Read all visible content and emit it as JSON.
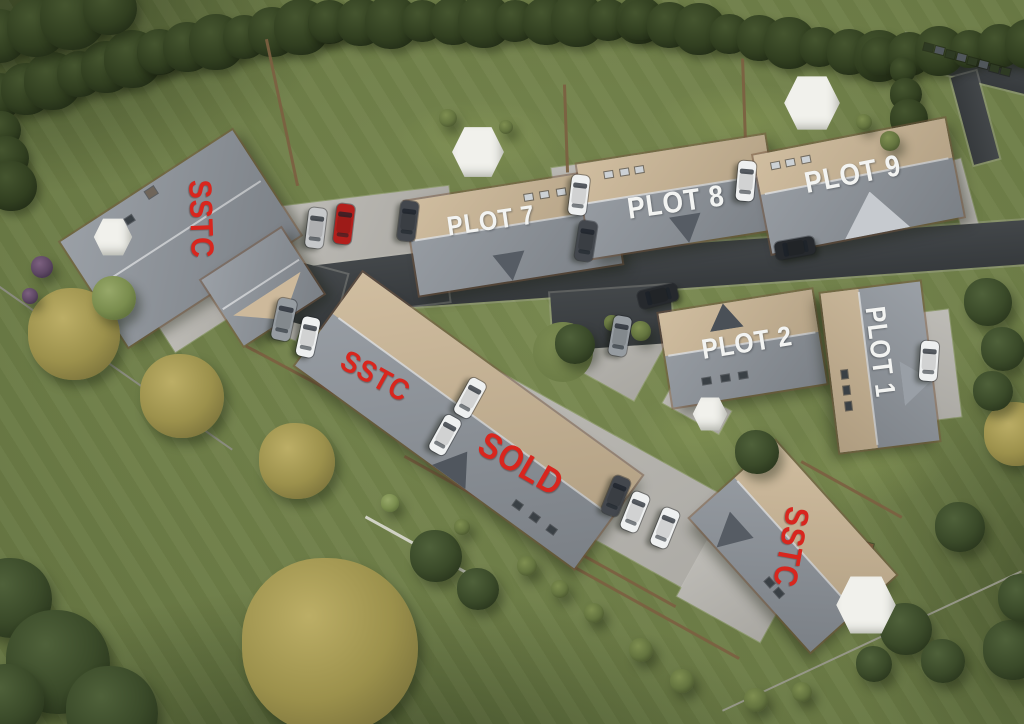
{
  "scene": {
    "width": 1024,
    "height": 724,
    "description": "Aerial 3D render site plan of housing development with plot and sale-status labels"
  },
  "palette": {
    "label_red": "#d8261e",
    "label_white": "#f3f4f2",
    "grass": "#6d7d47",
    "grass_light": "#7c8c52",
    "road": "#3b3f42",
    "paving": "#b6b4ae",
    "roof_gray": "#8f959c",
    "roof_tan": "#cbb695",
    "car_colors": {
      "silver": "#c6c8ca",
      "red": "#b31f1c",
      "dark": "#43474d",
      "white": "#eef0f0",
      "gray": "#969ca1",
      "black": "#26292d"
    },
    "tree": {
      "dark": [
        "#4f613a",
        "#3a4a29",
        "#27331b"
      ],
      "yellow": [
        "#bcae66",
        "#9c914c",
        "#78703a"
      ],
      "olive": [
        "#7f8f51",
        "#64743f",
        "#46522c"
      ],
      "light": [
        "#97a869",
        "#7a8d4e",
        "#5a6b38"
      ],
      "hedge": [
        "#45552f",
        "#313f20",
        "#1f2915"
      ],
      "purple": [
        "#7d6180",
        "#5d4763",
        "#3f3047"
      ]
    }
  },
  "labels": [
    {
      "id": "sstc-west-label",
      "text": "SSTC",
      "x": 201,
      "y": 219,
      "rot": 88,
      "size": 32,
      "color": "red"
    },
    {
      "id": "plot-7-label",
      "text": "PLOT 7",
      "x": 491,
      "y": 221,
      "rot": -8,
      "size": 27,
      "color": "white"
    },
    {
      "id": "plot-8-label",
      "text": "PLOT 8",
      "x": 676,
      "y": 203,
      "rot": -8,
      "size": 30,
      "color": "white"
    },
    {
      "id": "plot-9-label",
      "text": "PLOT 9",
      "x": 853,
      "y": 175,
      "rot": -11,
      "size": 30,
      "color": "white"
    },
    {
      "id": "plot-2-label",
      "text": "PLOT 2",
      "x": 747,
      "y": 343,
      "rot": -9,
      "size": 28,
      "color": "white"
    },
    {
      "id": "plot-1-label",
      "text": "PLOT 1",
      "x": 880,
      "y": 352,
      "rot": 83,
      "size": 28,
      "color": "white"
    },
    {
      "id": "sstc-mid-label",
      "text": "SSTC",
      "x": 375,
      "y": 377,
      "rot": 29,
      "size": 30,
      "color": "red"
    },
    {
      "id": "sold-label",
      "text": "SOLD",
      "x": 521,
      "y": 464,
      "rot": 30,
      "size": 36,
      "color": "red"
    },
    {
      "id": "sstc-south-label",
      "text": "SSTC",
      "x": 791,
      "y": 547,
      "rot": 100,
      "size": 33,
      "color": "red"
    }
  ],
  "houses": [
    {
      "id": "sstc-west",
      "x": 180,
      "y": 238,
      "w": 205,
      "h": 125,
      "rot": -33,
      "split": 0,
      "lights": [
        [
          0.18,
          0.15
        ],
        [
          0.26,
          0.15
        ],
        [
          0.34,
          0.15
        ]
      ],
      "lightColor": "dark",
      "chimney": [
        0.5,
        0.06
      ]
    },
    {
      "id": "sstc-west-wing",
      "x": 262,
      "y": 287,
      "w": 95,
      "h": 78,
      "rot": -33,
      "split": 0,
      "gable": {
        "side": "bottom",
        "at": 0.5,
        "wf": 0.85,
        "hf": 0.8,
        "apex": "out",
        "color": "#cdb99b"
      }
    },
    {
      "id": "plot-7",
      "x": 513,
      "y": 232,
      "w": 205,
      "h": 95,
      "rot": -9,
      "split": 0.42,
      "tan": "top",
      "lights": [
        [
          0.6,
          0.16
        ],
        [
          0.68,
          0.16
        ],
        [
          0.76,
          0.16
        ]
      ],
      "gable": {
        "side": "bottom",
        "at": 0.46,
        "wf": 0.16,
        "hf": 0.6,
        "apex": "out",
        "color": "#565c64"
      }
    },
    {
      "id": "plot-8",
      "x": 678,
      "y": 196,
      "w": 190,
      "h": 95,
      "rot": -9,
      "split": 0.42,
      "tan": "top",
      "lights": [
        [
          0.16,
          0.16
        ],
        [
          0.24,
          0.16
        ],
        [
          0.32,
          0.16
        ]
      ],
      "gable": {
        "side": "bottom",
        "at": 0.52,
        "wf": 0.17,
        "hf": 0.6,
        "apex": "out",
        "color": "#565c64"
      }
    },
    {
      "id": "plot-9",
      "x": 858,
      "y": 186,
      "w": 195,
      "h": 100,
      "rot": -11,
      "split": 0.4,
      "tan": "top",
      "lights": [
        [
          0.1,
          0.14
        ],
        [
          0.18,
          0.14
        ],
        [
          0.26,
          0.14
        ]
      ],
      "gable": {
        "side": "bottom",
        "at": 0.55,
        "wf": 0.34,
        "hf": 0.85,
        "apex": "in",
        "color": "#c6cacf"
      }
    },
    {
      "id": "plot-2",
      "x": 742,
      "y": 348,
      "w": 155,
      "h": 95,
      "rot": -9,
      "split": 0.45,
      "tan": "top",
      "lightColor": "dark",
      "lights": [
        [
          0.24,
          0.78
        ],
        [
          0.36,
          0.78
        ],
        [
          0.48,
          0.78
        ]
      ],
      "gable": {
        "side": "top",
        "at": 0.42,
        "wf": 0.22,
        "hf": 0.55,
        "apex": "out",
        "color": "#4a5057"
      }
    },
    {
      "id": "plot-1",
      "x": 880,
      "y": 367,
      "w": 160,
      "h": 100,
      "rot": 83,
      "split": 0.38,
      "tan": "bottom",
      "lightColor": "dark",
      "lights": [
        [
          0.52,
          0.86
        ],
        [
          0.62,
          0.86
        ],
        [
          0.72,
          0.86
        ]
      ],
      "gable": {
        "side": "top",
        "at": 0.62,
        "wf": 0.28,
        "hf": 0.6,
        "apex": "out",
        "color": "#999fa6"
      }
    },
    {
      "id": "sstc-sold-terrace",
      "x": 468,
      "y": 420,
      "w": 345,
      "h": 115,
      "rot": 36,
      "split": 0.44,
      "tan": "top",
      "lightColor": "dark",
      "lights": [
        [
          0.76,
          0.84
        ],
        [
          0.82,
          0.84
        ],
        [
          0.88,
          0.84
        ]
      ],
      "gable": {
        "side": "bottom",
        "at": 0.55,
        "wf": 0.12,
        "hf": 0.55,
        "apex": "in",
        "color": "#50565e"
      }
    },
    {
      "id": "sstc-south",
      "x": 793,
      "y": 546,
      "w": 180,
      "h": 115,
      "rot": 48,
      "split": 0.48,
      "tan": "top",
      "lightColor": "dark",
      "lights": [
        [
          0.56,
          0.86
        ],
        [
          0.64,
          0.86
        ]
      ],
      "gable": {
        "side": "bottom",
        "at": 0.22,
        "wf": 0.2,
        "hf": 0.6,
        "apex": "out",
        "color": "#565c64"
      }
    }
  ],
  "roads": [
    {
      "x": 655,
      "y": 268,
      "w": 760,
      "h": 44,
      "rot": -4
    },
    {
      "x": 352,
      "y": 287,
      "w": 190,
      "h": 52,
      "rot": -7
    },
    {
      "x": 296,
      "y": 292,
      "w": 90,
      "h": 60,
      "rot": 15
    },
    {
      "x": 612,
      "y": 318,
      "w": 120,
      "h": 58,
      "rot": -4
    },
    {
      "x": 966,
      "y": 64,
      "w": 130,
      "h": 30,
      "rot": 14
    },
    {
      "x": 975,
      "y": 118,
      "w": 90,
      "h": 26,
      "rot": 75
    }
  ],
  "paving": [
    {
      "x": 368,
      "y": 228,
      "w": 170,
      "h": 64,
      "rot": -7
    },
    {
      "x": 584,
      "y": 214,
      "w": 100,
      "h": 52,
      "rot": 82
    },
    {
      "x": 748,
      "y": 186,
      "w": 92,
      "h": 46,
      "rot": 81
    },
    {
      "x": 930,
      "y": 366,
      "w": 108,
      "h": 50,
      "rot": 83
    },
    {
      "x": 262,
      "y": 301,
      "w": 92,
      "h": 48,
      "rot": 22
    },
    {
      "x": 205,
      "y": 315,
      "w": 90,
      "h": 30,
      "rot": -33
    },
    {
      "x": 604,
      "y": 487,
      "w": 420,
      "h": 100,
      "rot": 29
    },
    {
      "x": 612,
      "y": 337,
      "w": 100,
      "h": 90,
      "rot": 29
    },
    {
      "x": 697,
      "y": 407,
      "w": 64,
      "h": 26,
      "rot": 29
    },
    {
      "x": 733,
      "y": 592,
      "w": 95,
      "h": 62,
      "rot": 29
    },
    {
      "x": 962,
      "y": 196,
      "w": 74,
      "h": 17,
      "rot": 75
    }
  ],
  "islands": [
    {
      "x": 563,
      "y": 352,
      "r": 30
    }
  ],
  "hedges": [
    {
      "from": [
        0,
        96
      ],
      "to": [
        160,
        52
      ],
      "r": 26,
      "step": 30
    },
    {
      "from": [
        160,
        52
      ],
      "to": [
        330,
        22
      ],
      "r": 25,
      "step": 30
    },
    {
      "from": [
        330,
        22
      ],
      "to": [
        640,
        20
      ],
      "r": 24,
      "step": 32
    },
    {
      "from": [
        640,
        20
      ],
      "to": [
        880,
        56
      ],
      "r": 23,
      "step": 30
    },
    {
      "from": [
        880,
        56
      ],
      "to": [
        1030,
        44
      ],
      "r": 22,
      "step": 30
    },
    {
      "from": [
        903,
        70
      ],
      "to": [
        918,
        190
      ],
      "r": 16,
      "step": 24
    },
    {
      "from": [
        0,
        36
      ],
      "to": [
        110,
        8
      ],
      "r": 30,
      "step": 34
    },
    {
      "from": [
        2,
        130
      ],
      "to": [
        12,
        186
      ],
      "r": 22,
      "step": 28
    }
  ],
  "fences": [
    {
      "x": 115,
      "y": 368,
      "len": 285,
      "rot": 35,
      "t": 2,
      "c": "#8d8d84"
    },
    {
      "x": 290,
      "y": 369,
      "len": 100,
      "rot": 28,
      "t": 3,
      "c": "#7c5f41"
    },
    {
      "x": 282,
      "y": 112,
      "len": 150,
      "rot": 78,
      "t": 3,
      "c": "#7c5f41"
    },
    {
      "x": 566,
      "y": 128,
      "len": 88,
      "rot": 88,
      "t": 3,
      "c": "#7c5f41"
    },
    {
      "x": 744,
      "y": 99,
      "len": 82,
      "rot": 88,
      "t": 3,
      "c": "#7c5f41"
    },
    {
      "x": 540,
      "y": 531,
      "len": 310,
      "rot": 29,
      "t": 3,
      "c": "#7c5f41"
    },
    {
      "x": 851,
      "y": 489,
      "len": 115,
      "rot": 29,
      "t": 3,
      "c": "#7c5f41"
    },
    {
      "x": 424,
      "y": 549,
      "len": 135,
      "rot": 29,
      "t": 3,
      "c": "#d9d9d0"
    },
    {
      "x": 872,
      "y": 641,
      "len": 330,
      "rot": -25,
      "t": 2,
      "c": "#9a9a8e"
    },
    {
      "x": 656,
      "y": 612,
      "len": 190,
      "rot": 29,
      "t": 3,
      "c": "#7c5f41"
    }
  ],
  "planters": [
    {
      "x": 928,
      "y": 47,
      "c": "#2e3a23"
    },
    {
      "x": 939,
      "y": 50,
      "c": "#51575c"
    },
    {
      "x": 950,
      "y": 54,
      "c": "#2e3a23"
    },
    {
      "x": 961,
      "y": 57,
      "c": "#51575c"
    },
    {
      "x": 972,
      "y": 61,
      "c": "#2e3a23"
    },
    {
      "x": 983,
      "y": 64,
      "c": "#51575c"
    },
    {
      "x": 994,
      "y": 68,
      "c": "#2e3a23"
    },
    {
      "x": 1005,
      "y": 71,
      "c": "#2e3a23"
    },
    {
      "x": 868,
      "y": 546,
      "c": "#7a5a3a"
    }
  ],
  "trees": [
    {
      "x": 12,
      "y": 598,
      "r": 40,
      "t": "dark"
    },
    {
      "x": 58,
      "y": 662,
      "r": 52,
      "t": "dark"
    },
    {
      "x": 112,
      "y": 712,
      "r": 46,
      "t": "dark"
    },
    {
      "x": 8,
      "y": 700,
      "r": 36,
      "t": "dark"
    },
    {
      "x": 330,
      "y": 646,
      "r": 88,
      "t": "yellow"
    },
    {
      "x": 74,
      "y": 334,
      "r": 46,
      "t": "yellow"
    },
    {
      "x": 182,
      "y": 396,
      "r": 42,
      "t": "yellow"
    },
    {
      "x": 297,
      "y": 461,
      "r": 38,
      "t": "yellow"
    },
    {
      "x": 1016,
      "y": 434,
      "r": 32,
      "t": "yellow"
    },
    {
      "x": 114,
      "y": 298,
      "r": 22,
      "t": "light"
    },
    {
      "x": 436,
      "y": 556,
      "r": 26,
      "t": "dark"
    },
    {
      "x": 478,
      "y": 589,
      "r": 21,
      "t": "dark"
    },
    {
      "x": 575,
      "y": 344,
      "r": 20,
      "t": "dark"
    },
    {
      "x": 757,
      "y": 452,
      "r": 22,
      "t": "dark"
    },
    {
      "x": 988,
      "y": 302,
      "r": 24,
      "t": "dark"
    },
    {
      "x": 1003,
      "y": 349,
      "r": 22,
      "t": "dark"
    },
    {
      "x": 993,
      "y": 391,
      "r": 20,
      "t": "dark"
    },
    {
      "x": 960,
      "y": 527,
      "r": 25,
      "t": "dark"
    },
    {
      "x": 906,
      "y": 629,
      "r": 26,
      "t": "dark"
    },
    {
      "x": 943,
      "y": 661,
      "r": 22,
      "t": "dark"
    },
    {
      "x": 874,
      "y": 664,
      "r": 18,
      "t": "dark"
    },
    {
      "x": 1013,
      "y": 650,
      "r": 30,
      "t": "dark"
    },
    {
      "x": 1022,
      "y": 598,
      "r": 24,
      "t": "dark"
    },
    {
      "x": 448,
      "y": 118,
      "r": 9,
      "t": "olive"
    },
    {
      "x": 506,
      "y": 127,
      "r": 7,
      "t": "olive"
    },
    {
      "x": 527,
      "y": 566,
      "r": 10,
      "t": "olive"
    },
    {
      "x": 560,
      "y": 589,
      "r": 9,
      "t": "olive"
    },
    {
      "x": 594,
      "y": 613,
      "r": 10,
      "t": "olive"
    },
    {
      "x": 641,
      "y": 650,
      "r": 12,
      "t": "olive"
    },
    {
      "x": 682,
      "y": 681,
      "r": 12,
      "t": "olive"
    },
    {
      "x": 756,
      "y": 700,
      "r": 12,
      "t": "olive"
    },
    {
      "x": 802,
      "y": 692,
      "r": 10,
      "t": "olive"
    },
    {
      "x": 641,
      "y": 331,
      "r": 10,
      "t": "olive"
    },
    {
      "x": 612,
      "y": 323,
      "r": 8,
      "t": "olive"
    },
    {
      "x": 890,
      "y": 141,
      "r": 10,
      "t": "olive"
    },
    {
      "x": 864,
      "y": 122,
      "r": 8,
      "t": "olive"
    },
    {
      "x": 42,
      "y": 267,
      "r": 11,
      "t": "purple"
    },
    {
      "x": 30,
      "y": 296,
      "r": 8,
      "t": "purple"
    },
    {
      "x": 390,
      "y": 503,
      "r": 9,
      "t": "light"
    },
    {
      "x": 462,
      "y": 527,
      "r": 8,
      "t": "olive"
    }
  ],
  "cars": [
    {
      "x": 316,
      "y": 228,
      "rot": 97,
      "c": "silver"
    },
    {
      "x": 344,
      "y": 224,
      "rot": 97,
      "c": "red"
    },
    {
      "x": 408,
      "y": 221,
      "rot": 97,
      "c": "dark"
    },
    {
      "x": 579,
      "y": 195,
      "rot": 97,
      "c": "white"
    },
    {
      "x": 586,
      "y": 241,
      "rot": 99,
      "c": "dark"
    },
    {
      "x": 746,
      "y": 181,
      "rot": 95,
      "c": "white"
    },
    {
      "x": 795,
      "y": 248,
      "rot": -10,
      "c": "black"
    },
    {
      "x": 658,
      "y": 296,
      "rot": -14,
      "c": "black"
    },
    {
      "x": 620,
      "y": 336,
      "rot": 100,
      "c": "gray"
    },
    {
      "x": 929,
      "y": 361,
      "rot": 94,
      "c": "white"
    },
    {
      "x": 284,
      "y": 319,
      "rot": 102,
      "c": "gray",
      "len": 42,
      "wid": 19
    },
    {
      "x": 308,
      "y": 337,
      "rot": 102,
      "c": "white"
    },
    {
      "x": 470,
      "y": 398,
      "rot": 119,
      "c": "white"
    },
    {
      "x": 445,
      "y": 435,
      "rot": 119,
      "c": "white"
    },
    {
      "x": 616,
      "y": 496,
      "rot": 112,
      "c": "dark"
    },
    {
      "x": 635,
      "y": 512,
      "rot": 112,
      "c": "white"
    },
    {
      "x": 665,
      "y": 528,
      "rot": 112,
      "c": "white"
    }
  ],
  "parasols": [
    {
      "x": 478,
      "y": 152,
      "r": 27
    },
    {
      "x": 812,
      "y": 103,
      "r": 29
    },
    {
      "x": 866,
      "y": 605,
      "r": 31
    },
    {
      "x": 113,
      "y": 237,
      "r": 20
    },
    {
      "x": 710,
      "y": 414,
      "r": 18
    }
  ],
  "patches": [
    {
      "x": 480,
      "y": 140,
      "w": 240,
      "h": 110,
      "c": "rgba(150,168,92,.30)"
    },
    {
      "x": 745,
      "y": 120,
      "w": 260,
      "h": 100,
      "c": "rgba(150,168,92,.30)"
    },
    {
      "x": 170,
      "y": 255,
      "w": 260,
      "h": 150,
      "c": "rgba(150,168,92,.22)"
    },
    {
      "x": 865,
      "y": 462,
      "w": 220,
      "h": 130,
      "c": "rgba(150,168,92,.25)"
    },
    {
      "x": 700,
      "y": 432,
      "w": 190,
      "h": 110,
      "c": "rgba(150,168,92,.25)"
    }
  ]
}
